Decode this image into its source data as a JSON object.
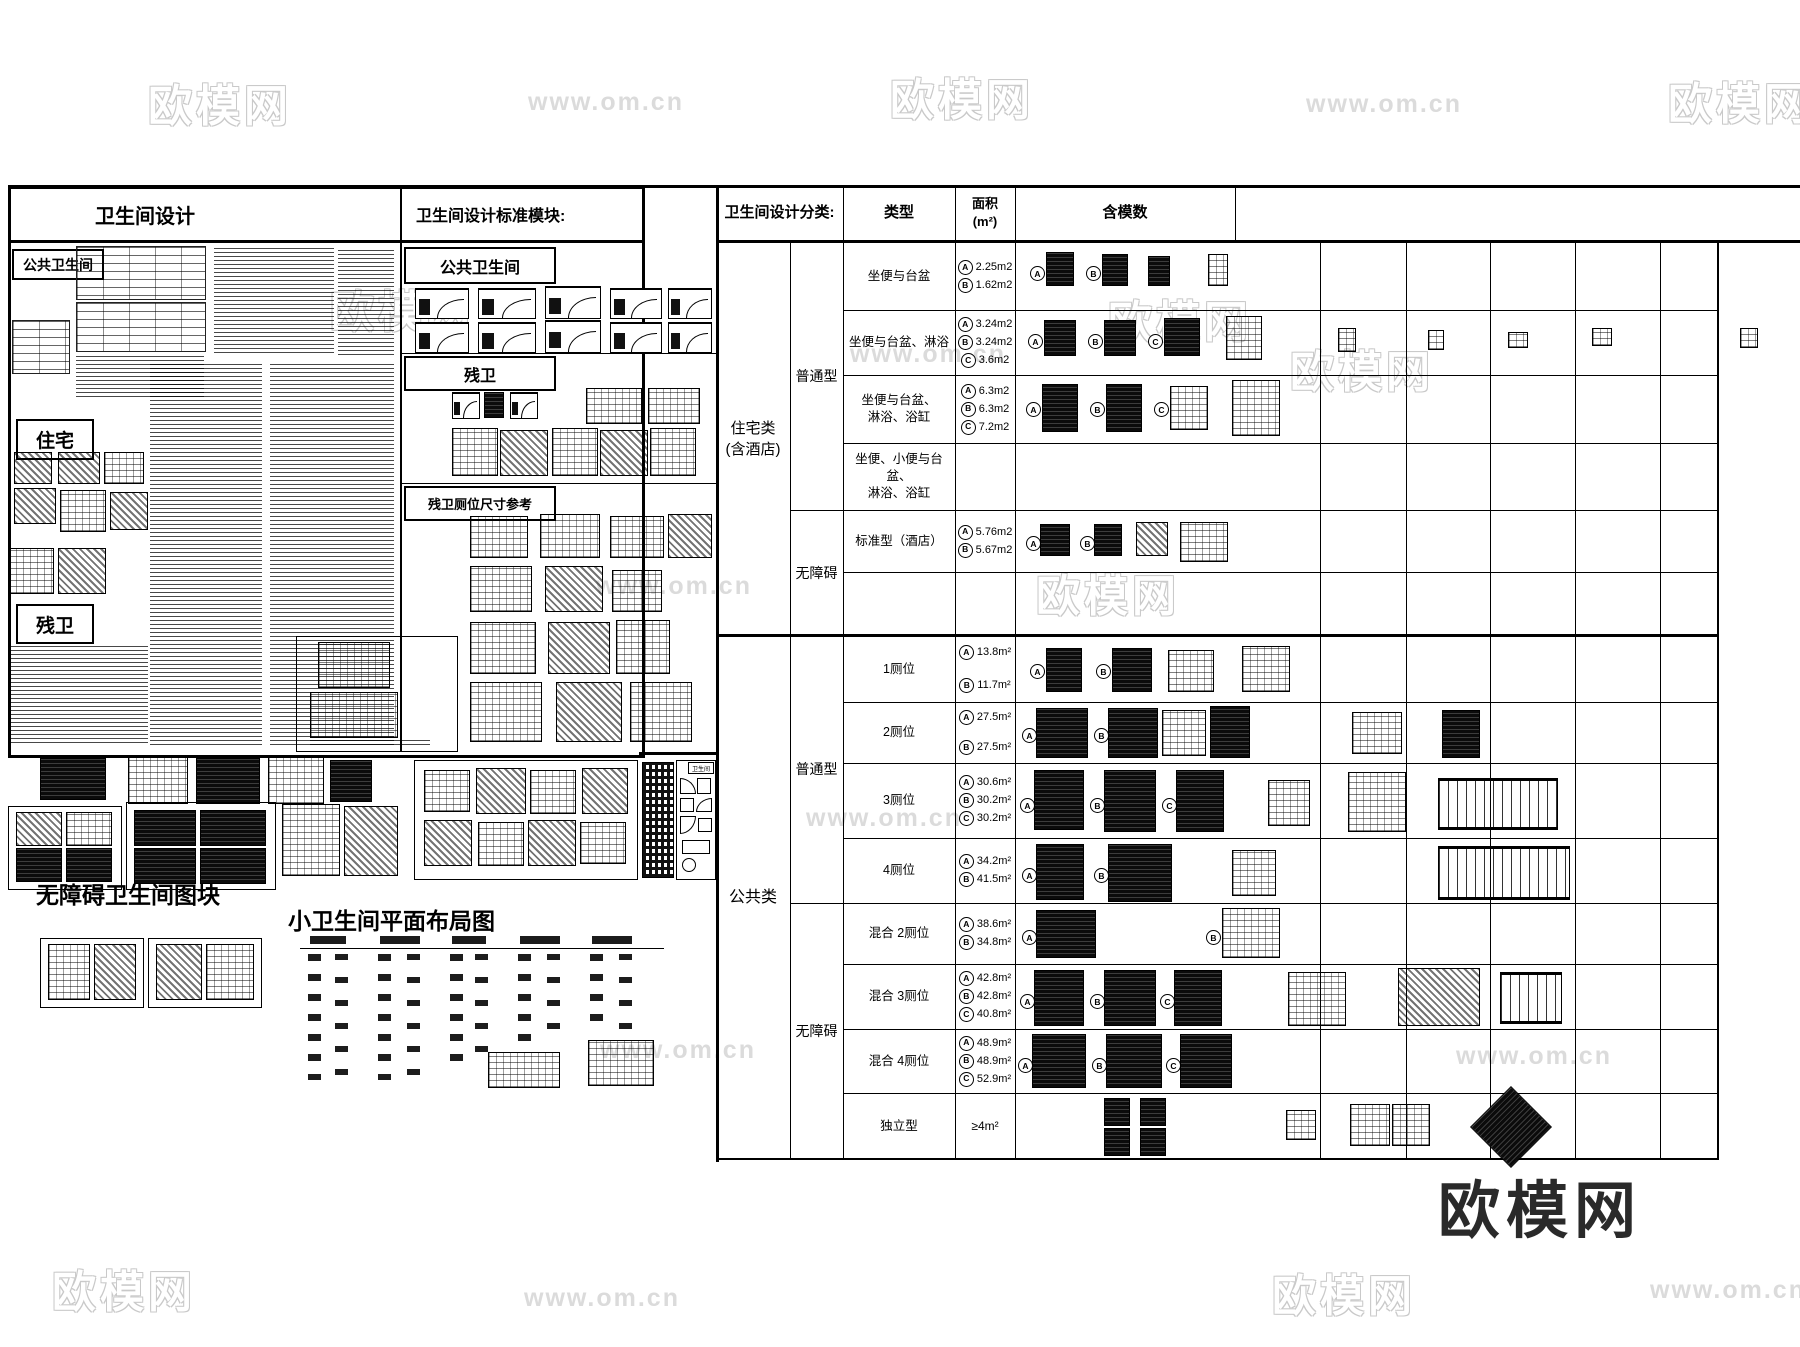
{
  "watermarks": {
    "brand": "欧模网",
    "url": "www.om.cn"
  },
  "logo": {
    "text": "欧模网"
  },
  "left_sheet": {
    "title": "卫生间设计",
    "public_section": "公共卫生间",
    "residence_section": "住宅",
    "accessible_section": "残卫",
    "blocks_caption": "无障碍卫生间图块",
    "small_layout_caption": "小卫生间平面布局图"
  },
  "modules_panel": {
    "title": "卫生间设计标准模块:",
    "band1": "公共卫生间",
    "band2": "残卫",
    "band3": "残卫厕位尺寸参考",
    "legend_title": "卫生间"
  },
  "classification_table": {
    "title": "卫生间设计分类:",
    "col_type": "类型",
    "col_area": "面积\n(m²)",
    "col_modules": "含模数",
    "groups": [
      {
        "label": "住宅类\n(含酒店)"
      },
      {
        "label": "公共类"
      }
    ],
    "subgroups": [
      "普通型",
      "无障碍",
      "普通型",
      "无障碍"
    ],
    "rows": [
      {
        "type": "坐便与台盆",
        "marks": [
          "A",
          "B"
        ],
        "areas": [
          {
            "m": "A",
            "v": "2.25m2"
          },
          {
            "m": "B",
            "v": "1.62m2"
          }
        ]
      },
      {
        "type": "坐便与台盆、淋浴",
        "marks": [
          "A",
          "B",
          "C"
        ],
        "areas": [
          {
            "m": "A",
            "v": "3.24m2"
          },
          {
            "m": "B",
            "v": "3.24m2"
          },
          {
            "m": "C",
            "v": "3.6m2"
          }
        ]
      },
      {
        "type": "坐便与台盆、\n淋浴、浴缸",
        "marks": [
          "A",
          "B",
          "C"
        ],
        "areas": [
          {
            "m": "A",
            "v": "6.3m2"
          },
          {
            "m": "B",
            "v": "6.3m2"
          },
          {
            "m": "C",
            "v": "7.2m2"
          }
        ]
      },
      {
        "type": "坐便、小便与台盆、\n淋浴、浴缸",
        "marks": [],
        "areas": []
      },
      {
        "type": "标准型（酒店）",
        "marks": [
          "A",
          "B"
        ],
        "areas": [
          {
            "m": "A",
            "v": "5.76m2"
          },
          {
            "m": "B",
            "v": "5.67m2"
          }
        ]
      },
      {
        "type": "",
        "marks": [],
        "areas": []
      },
      {
        "type": "1厕位",
        "marks": [
          "A",
          "B"
        ],
        "areas": [
          {
            "m": "A",
            "v": "13.8m²"
          },
          {
            "m": "B",
            "v": "11.7m²"
          }
        ]
      },
      {
        "type": "2厕位",
        "marks": [
          "A",
          "B"
        ],
        "areas": [
          {
            "m": "A",
            "v": "27.5m²"
          },
          {
            "m": "B",
            "v": "27.5m²"
          }
        ]
      },
      {
        "type": "3厕位",
        "marks": [
          "A",
          "B",
          "C"
        ],
        "areas": [
          {
            "m": "A",
            "v": "30.6m²"
          },
          {
            "m": "B",
            "v": "30.2m²"
          },
          {
            "m": "C",
            "v": "30.2m²"
          }
        ]
      },
      {
        "type": "4厕位",
        "marks": [
          "A",
          "B"
        ],
        "areas": [
          {
            "m": "A",
            "v": "34.2m²"
          },
          {
            "m": "B",
            "v": "41.5m²"
          }
        ]
      },
      {
        "type": "混合  2厕位",
        "marks": [
          "A",
          "B"
        ],
        "areas": [
          {
            "m": "A",
            "v": "38.6m²"
          },
          {
            "m": "B",
            "v": "34.8m²"
          }
        ]
      },
      {
        "type": "混合  3厕位",
        "marks": [
          "A",
          "B",
          "C"
        ],
        "areas": [
          {
            "m": "A",
            "v": "42.8m²"
          },
          {
            "m": "B",
            "v": "42.8m²"
          },
          {
            "m": "C",
            "v": "40.8m²"
          }
        ]
      },
      {
        "type": "混合  4厕位",
        "marks": [
          "A",
          "B",
          "C"
        ],
        "areas": [
          {
            "m": "A",
            "v": "48.9m²"
          },
          {
            "m": "B",
            "v": "48.9m²"
          },
          {
            "m": "C",
            "v": "52.9m²"
          }
        ]
      },
      {
        "type": "独立型",
        "marks": [],
        "areas": [
          {
            "m": "",
            "v": "≥4m²"
          }
        ]
      }
    ]
  }
}
